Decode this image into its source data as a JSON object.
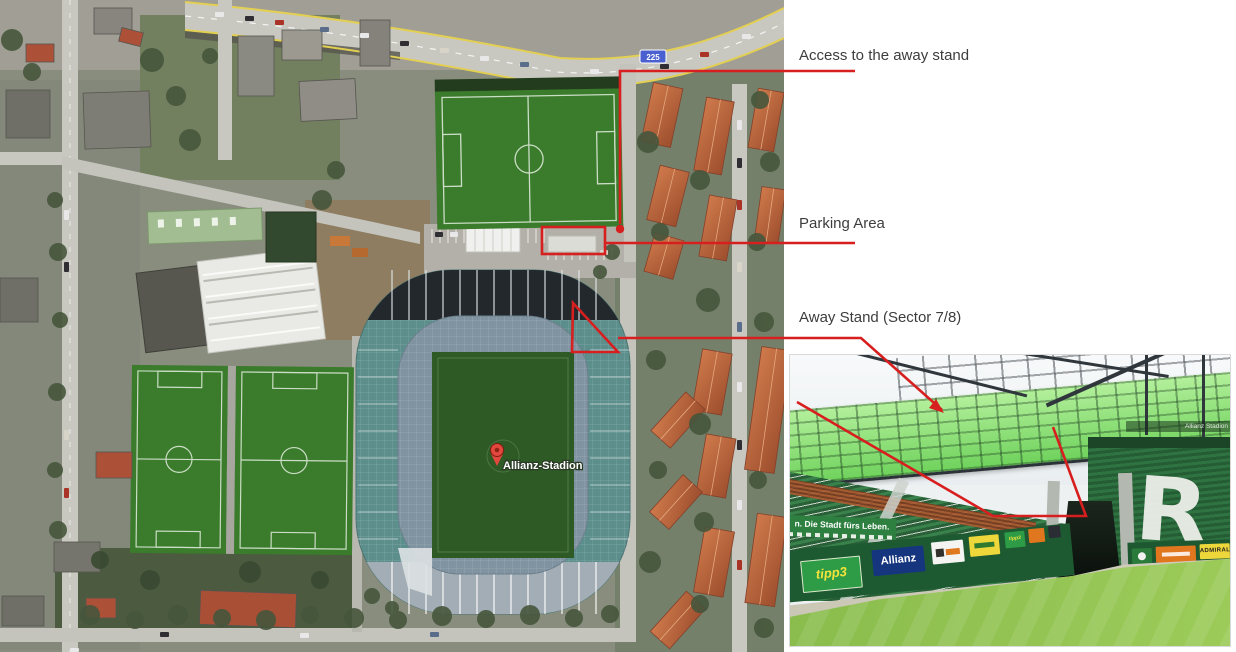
{
  "annotations": {
    "accent_color": "#d81f1f",
    "items": [
      {
        "label": "Access to the away stand"
      },
      {
        "label": "Parking Area"
      },
      {
        "label": "Away Stand (Sector 7/8)"
      }
    ]
  },
  "map": {
    "place_label": "Allianz-Stadion",
    "road_shield": "225",
    "colors": {
      "pitch_green": "#3b7b2c",
      "stadium_roof_teal": "#5c8e8c",
      "residential_roof": "#bf6a43",
      "road_line_yellow": "#e3cf52"
    }
  },
  "photo": {
    "banner": "n. Die Stadt fürs Leben.",
    "stadium_sign": "Allianz Stadion",
    "seat_letter": "R",
    "ad_boards": [
      "tipp3",
      "Allianz",
      "tipp3",
      "ADMIRAL"
    ]
  }
}
